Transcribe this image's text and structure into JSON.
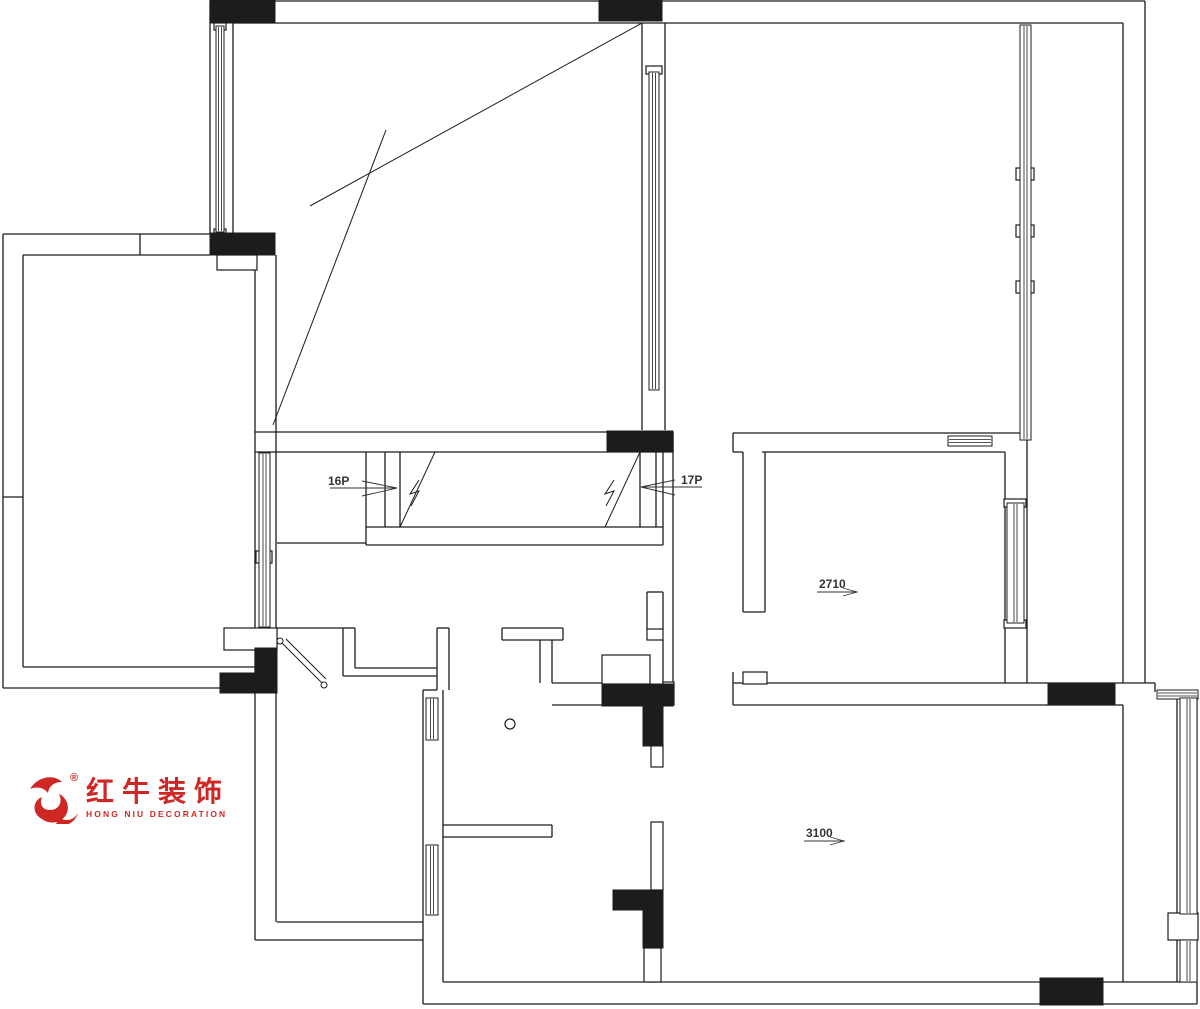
{
  "logo": {
    "cn": "红牛装饰",
    "en": "HONG NIU DECORATION",
    "reg": "®",
    "color": "#cf2724"
  },
  "plan": {
    "wall_color": "#1c1c1c",
    "anno_color": "#333333",
    "labels": [
      {
        "t": "16P",
        "x": 328,
        "y": 485,
        "fs": 12
      },
      {
        "t": "17P",
        "x": 681,
        "y": 484,
        "fs": 12
      },
      {
        "t": "2710",
        "x": 819,
        "y": 588,
        "fs": 12
      },
      {
        "t": "3100",
        "x": 806,
        "y": 837,
        "fs": 12
      }
    ],
    "walls": [
      [
        210,
        1,
        1145,
        1
      ],
      [
        233,
        23,
        1123,
        23
      ],
      [
        210,
        1,
        210,
        233
      ],
      [
        233,
        23,
        233,
        233
      ],
      [
        3,
        234,
        210,
        234
      ],
      [
        23,
        255,
        210,
        255
      ],
      [
        140,
        234,
        140,
        255
      ],
      [
        3,
        234,
        3,
        688
      ],
      [
        23,
        255,
        23,
        667
      ],
      [
        3,
        497,
        23,
        497
      ],
      [
        3,
        688,
        277,
        688
      ],
      [
        23,
        667,
        255,
        667
      ],
      [
        255,
        255,
        255,
        940
      ],
      [
        276,
        255,
        276,
        922
      ],
      [
        642,
        23,
        642,
        430
      ],
      [
        665,
        23,
        665,
        430
      ],
      [
        1123,
        23,
        1123,
        683
      ],
      [
        1145,
        1,
        1145,
        683
      ],
      [
        255,
        432,
        673,
        432
      ],
      [
        255,
        452,
        673,
        452
      ],
      [
        673,
        432,
        673,
        452
      ],
      [
        366,
        452,
        366,
        527
      ],
      [
        385,
        452,
        385,
        527
      ],
      [
        400,
        452,
        400,
        527
      ],
      [
        640,
        452,
        640,
        527
      ],
      [
        656,
        452,
        656,
        527
      ],
      [
        663,
        452,
        663,
        527
      ],
      [
        366,
        527,
        663,
        527
      ],
      [
        366,
        545,
        663,
        545
      ],
      [
        366,
        527,
        366,
        545
      ],
      [
        663,
        527,
        663,
        545
      ],
      [
        277,
        543,
        366,
        543
      ],
      [
        277,
        628,
        343,
        628
      ],
      [
        343,
        628,
        343,
        676
      ],
      [
        355,
        628,
        355,
        668
      ],
      [
        343,
        628,
        355,
        628
      ],
      [
        355,
        668,
        437,
        668
      ],
      [
        343,
        676,
        437,
        676
      ],
      [
        437,
        628,
        449,
        628
      ],
      [
        437,
        628,
        437,
        690
      ],
      [
        449,
        628,
        449,
        690
      ],
      [
        423,
        690,
        437,
        690
      ],
      [
        423,
        690,
        423,
        1004
      ],
      [
        443,
        690,
        443,
        982
      ],
      [
        255,
        940,
        423,
        940
      ],
      [
        277,
        922,
        423,
        922
      ],
      [
        502,
        628,
        563,
        628
      ],
      [
        502,
        640,
        563,
        640
      ],
      [
        502,
        628,
        502,
        640
      ],
      [
        563,
        628,
        563,
        640
      ],
      [
        540,
        640,
        540,
        683
      ],
      [
        552,
        640,
        552,
        683
      ],
      [
        443,
        825,
        552,
        825
      ],
      [
        443,
        837,
        552,
        837
      ],
      [
        552,
        825,
        552,
        837
      ],
      [
        552,
        683,
        602,
        683
      ],
      [
        552,
        705,
        602,
        705
      ],
      [
        647,
        592,
        647,
        629
      ],
      [
        663,
        592,
        663,
        629
      ],
      [
        647,
        592,
        663,
        592
      ],
      [
        663,
        640,
        663,
        683
      ],
      [
        673,
        433,
        673,
        683
      ],
      [
        733,
        433,
        1027,
        433
      ],
      [
        733,
        433,
        733,
        452
      ],
      [
        733,
        452,
        743,
        452
      ],
      [
        762,
        452,
        1005,
        452
      ],
      [
        743,
        452,
        743,
        612
      ],
      [
        765,
        452,
        765,
        612
      ],
      [
        743,
        612,
        765,
        612
      ],
      [
        1005,
        452,
        1005,
        683
      ],
      [
        1027,
        433,
        1027,
        683
      ],
      [
        733,
        683,
        1155,
        683
      ],
      [
        733,
        705,
        1123,
        705
      ],
      [
        733,
        672,
        733,
        705
      ],
      [
        1155,
        683,
        1155,
        692
      ],
      [
        1123,
        705,
        1123,
        982
      ],
      [
        1177,
        699,
        1177,
        982
      ],
      [
        443,
        982,
        1197,
        982
      ],
      [
        423,
        1004,
        1197,
        1004
      ],
      [
        1197,
        690,
        1197,
        1004
      ]
    ],
    "diagonals": [
      [
        642,
        23,
        310,
        206
      ],
      [
        386,
        130,
        273,
        425
      ],
      [
        435,
        452,
        400,
        527
      ],
      [
        640,
        452,
        605,
        527
      ]
    ],
    "annotation_lines": [
      [
        330,
        488,
        397,
        488
      ],
      [
        362,
        481,
        397,
        488
      ],
      [
        362,
        496,
        397,
        488
      ],
      [
        641,
        487,
        702,
        487
      ],
      [
        675,
        480,
        641,
        487
      ],
      [
        675,
        495,
        641,
        487
      ],
      [
        817,
        592,
        858,
        592
      ],
      [
        843,
        588,
        857,
        592
      ],
      [
        843,
        596,
        857,
        592
      ],
      [
        804,
        841,
        845,
        841
      ],
      [
        830,
        837,
        844,
        841
      ],
      [
        830,
        845,
        844,
        841
      ]
    ],
    "white_rects": [
      [
        217,
        255,
        40,
        15
      ],
      [
        224,
        628,
        53,
        22
      ],
      [
        647,
        629,
        16,
        11
      ],
      [
        602,
        655,
        48,
        29
      ],
      [
        663,
        682,
        11,
        23
      ],
      [
        651,
        745,
        12,
        22
      ],
      [
        651,
        822,
        12,
        68
      ],
      [
        644,
        948,
        17,
        34
      ],
      [
        743,
        672,
        24,
        12
      ],
      [
        1168,
        913,
        30,
        27
      ],
      [
        256,
        551,
        16,
        12
      ],
      [
        1016,
        168,
        18,
        12
      ],
      [
        1016,
        225,
        18,
        12
      ],
      [
        1016,
        281,
        18,
        12
      ],
      [
        1004,
        499,
        22,
        8
      ],
      [
        1004,
        620,
        22,
        8
      ],
      [
        646,
        66,
        16,
        8
      ],
      [
        214,
        23,
        12,
        7
      ],
      [
        214,
        229,
        12,
        7
      ]
    ],
    "black_rects": [
      [
        210,
        0,
        65,
        23
      ],
      [
        599,
        0,
        63,
        21
      ],
      [
        210,
        233,
        65,
        22
      ],
      [
        607,
        431,
        66,
        21
      ],
      [
        255,
        648,
        22,
        45
      ],
      [
        220,
        673,
        35,
        20
      ],
      [
        602,
        684,
        71,
        22
      ],
      [
        643,
        706,
        20,
        40
      ],
      [
        613,
        890,
        50,
        20
      ],
      [
        643,
        910,
        20,
        38
      ],
      [
        1048,
        683,
        67,
        22
      ],
      [
        1040,
        978,
        63,
        27
      ]
    ],
    "windows": [
      {
        "x": 216,
        "y": 26,
        "w": 8,
        "h": 206,
        "o": "v"
      },
      {
        "x": 259,
        "y": 453,
        "w": 11,
        "h": 174,
        "o": "v"
      },
      {
        "x": 649,
        "y": 72,
        "w": 10,
        "h": 318,
        "o": "v"
      },
      {
        "x": 1020,
        "y": 25,
        "w": 11,
        "h": 415,
        "o": "v"
      },
      {
        "x": 1007,
        "y": 503,
        "w": 17,
        "h": 120,
        "o": "v"
      },
      {
        "x": 948,
        "y": 436,
        "w": 44,
        "h": 10,
        "o": "h"
      },
      {
        "x": 1157,
        "y": 690,
        "w": 41,
        "h": 9,
        "o": "h"
      },
      {
        "x": 1180,
        "y": 698,
        "w": 17,
        "h": 216,
        "o": "v"
      },
      {
        "x": 1180,
        "y": 940,
        "w": 17,
        "h": 42,
        "o": "v"
      },
      {
        "x": 426,
        "y": 698,
        "w": 12,
        "h": 42,
        "o": "v"
      },
      {
        "x": 426,
        "y": 845,
        "w": 12,
        "h": 70,
        "o": "v"
      }
    ],
    "door": {
      "lines": [
        [
          282,
          643,
          322,
          683
        ],
        [
          286,
          639,
          326,
          679
        ]
      ],
      "hinges": [
        [
          280,
          641
        ],
        [
          324,
          685
        ]
      ]
    },
    "breaks": [
      [
        [
          419,
          480
        ],
        [
          410,
          494
        ],
        [
          419,
          491
        ],
        [
          411,
          506
        ]
      ],
      [
        [
          614,
          480
        ],
        [
          605,
          494
        ],
        [
          614,
          491
        ],
        [
          606,
          506
        ]
      ]
    ],
    "circle": {
      "cx": 510,
      "cy": 724,
      "r": 5
    }
  }
}
